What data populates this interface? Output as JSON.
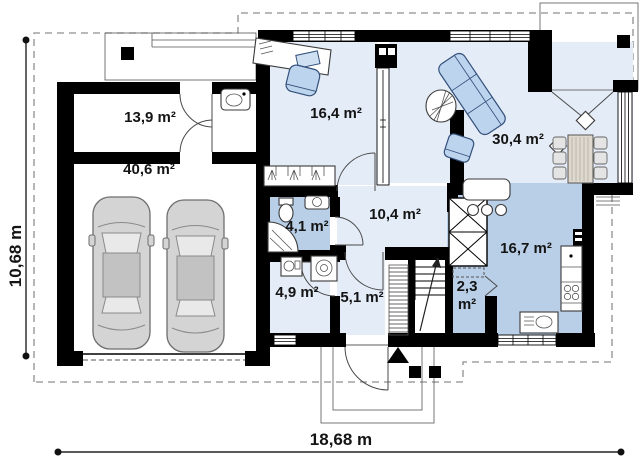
{
  "plan": {
    "type": "floor-plan",
    "dimensions": {
      "width_label": "18,68 m",
      "height_label": "10,68 m"
    },
    "rooms": [
      {
        "id": "utility-room",
        "area_label": "13,9 m²"
      },
      {
        "id": "garage",
        "area_label": "40,6 m²"
      },
      {
        "id": "office",
        "area_label": "16,4 m²"
      },
      {
        "id": "living-room",
        "area_label": "30,4 m²"
      },
      {
        "id": "bathroom",
        "area_label": "4,1 m²"
      },
      {
        "id": "hall",
        "area_label": "10,4 m²"
      },
      {
        "id": "kitchen",
        "area_label": "16,7 m²"
      },
      {
        "id": "laundry",
        "area_label": "4,9 m²"
      },
      {
        "id": "corridor",
        "area_label": "5,1 m²"
      },
      {
        "id": "pantry",
        "area_label_line1": "2,3",
        "area_label_line2": "m²"
      }
    ],
    "colors": {
      "wall": "#000000",
      "floor_light": "#e4ecf7",
      "floor_blue": "#b9cfe7",
      "furniture_blue": "#bdd4ee",
      "car_gray": "#d4d4d4",
      "roof_dashed": "#8f8f8f",
      "label_text": "#141414"
    }
  }
}
